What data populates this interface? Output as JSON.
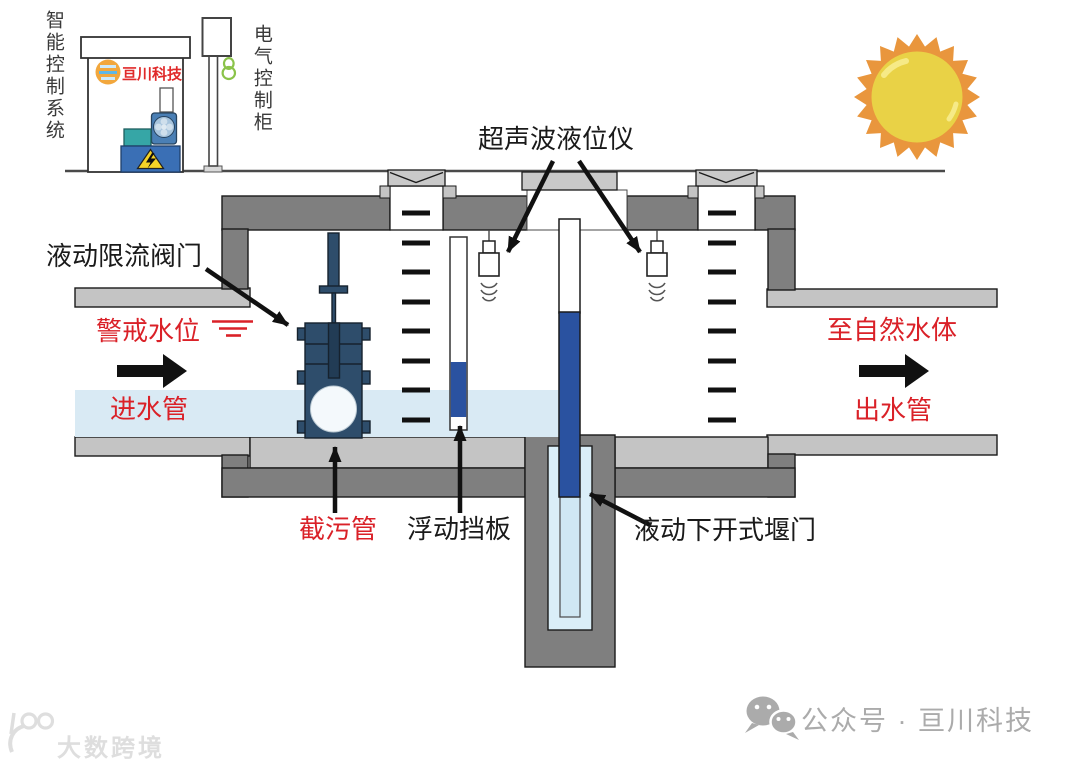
{
  "labels": {
    "smart_control_system": "智能控制系统",
    "electrical_control_cabinet": "电气控制柜",
    "ultrasonic_level_meter": "超声波液位仪",
    "hydraulic_flow_limiting_valve": "液动限流阀门",
    "warning_water_level": "警戒水位",
    "inlet_pipe": "进水管",
    "to_natural_water_body": "至自然水体",
    "outlet_pipe": "出水管",
    "sewage_interception_pipe": "截污管",
    "floating_baffle": "浮动挡板",
    "hydraulic_bottom_opening_weir_gate": "液动下开式堰门"
  },
  "branding": {
    "booth_logo": "亘川科技",
    "wechat_public_account": "公众号 · 亘川科技",
    "watermark": "大数跨境"
  },
  "icons": {
    "sun": "sun-icon",
    "wechat": "wechat-icon",
    "manhole_cover": "manhole-cover-icon",
    "warning_lightning": "lightning-warning-icon",
    "cable_coil": "cable-coil-icon",
    "pump": "pump-icon",
    "watermark_logo": "watermark-logo-icon"
  },
  "colors": {
    "wall_dark": "#7f7f7f",
    "wall_light": "#c4c4c4",
    "water_light_blue": "#d9eaf4",
    "valve_navy": "#2e4d6b",
    "gate_blue": "#2a52a0",
    "label_red": "#da2128",
    "sun_orange": "#e9963d",
    "sun_yellow": "#e9d246",
    "footer_gray": "#ababab"
  }
}
